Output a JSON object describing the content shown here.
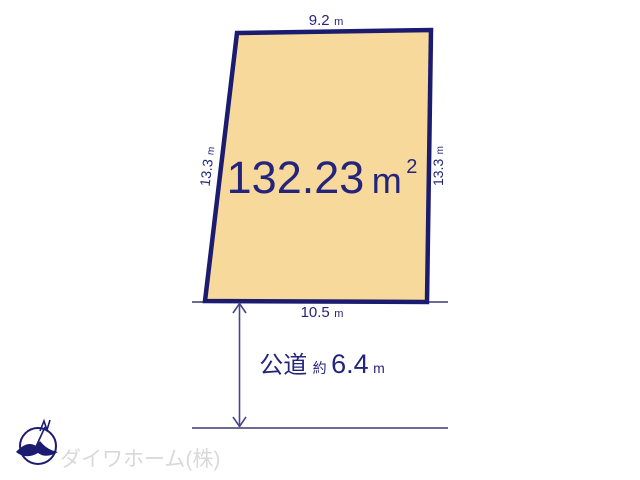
{
  "diagram": {
    "title": "land-plot-site-plan",
    "parcel": {
      "area": {
        "value": "132.23",
        "unit_m": "m",
        "unit_sup": "2"
      },
      "top_edge": {
        "value": "9.2",
        "unit": "m"
      },
      "left_edge": {
        "value": "13.3",
        "unit": "m"
      },
      "right_edge": {
        "value": "13.3",
        "unit": "m"
      },
      "bottom_edge": {
        "value": "10.5",
        "unit": "m"
      }
    },
    "road": {
      "type_label": "公道",
      "approx_label": "約",
      "width_value": "6.4",
      "unit": "m"
    },
    "branding": {
      "company": "ダイワホーム(株)"
    },
    "colors": {
      "parcel_fill": "#f8d99c",
      "parcel_border": "#1b1b70",
      "dimension_text": "#24247c",
      "road_line": "#6b6b93",
      "arrow_line": "#45458c",
      "company_text": "#d9d9d9"
    }
  }
}
